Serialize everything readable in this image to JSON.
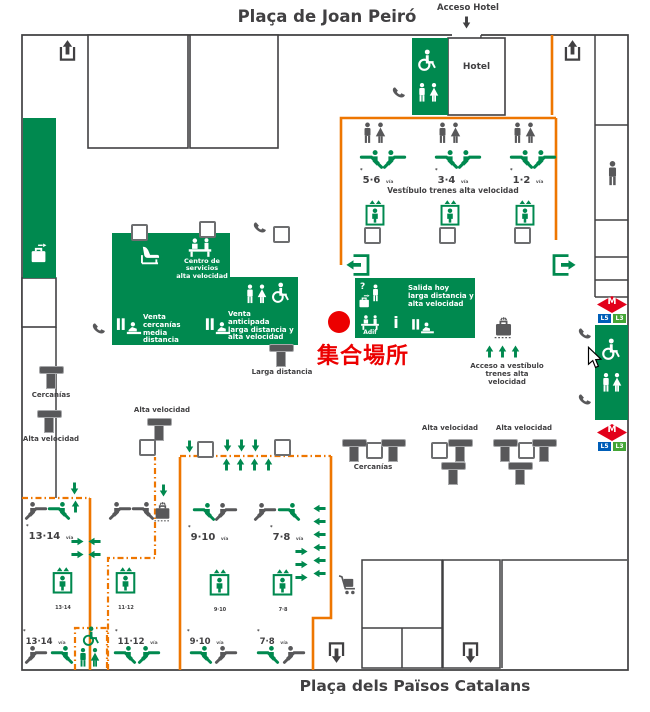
{
  "colors": {
    "green": "#00894f",
    "orange": "#ee7601",
    "dark_gray": "#414042",
    "icon_gray": "#58585a",
    "red": "#ec0000",
    "metro_red": "#e2001a",
    "line5_blue": "#005eb8",
    "line3_green": "#43a536"
  },
  "header": {
    "title": "Plaça de Joan Peiró",
    "acceso_hotel": "Acceso Hotel"
  },
  "footer": {
    "title": "Plaça dels Països Catalans"
  },
  "hotel": {
    "label": "Hotel"
  },
  "vestibulo": {
    "label": "Vestíbulo trenes alta velocidad",
    "platforms": [
      {
        "num": "5·6",
        "suffix": "vía"
      },
      {
        "num": "3·4",
        "suffix": "vía"
      },
      {
        "num": "1·2",
        "suffix": "vía"
      }
    ]
  },
  "services": {
    "centro_servicios": "Centro de servicios\nalta velocidad",
    "venta_cercanias": "Venta\ncercanías\nmedia distancia",
    "venta_anticipada": "Venta anticipada\nlarga distancia y\nalta velocidad",
    "salida_hoy": "Salida hoy\nlarga distancia y\nalta velocidad",
    "adif": "Adif",
    "info_letter": "i",
    "question_mark": "?"
  },
  "signs": {
    "larga_distancia": "Larga distancia",
    "cercanias_left": "Cercanías",
    "alta_velocidad_left": "Alta velocidad",
    "alta_velocidad_center": "Alta velocidad",
    "cercanias_mid": "Cercanías",
    "alta_velocidad_mid_1": "Alta velocidad",
    "alta_velocidad_mid_2": "Alta velocidad",
    "acceso_vestibulo": "Acceso a vestíbulo\ntrenes alta velocidad"
  },
  "meeting_point": {
    "label": "集合場所"
  },
  "platforms_lower": {
    "groups": [
      {
        "num": "13·14",
        "suffix": "vía",
        "lift": "13·14"
      },
      {
        "lift": "11·12"
      },
      {
        "num": "9·10",
        "suffix": "vía",
        "lift": "9·10"
      },
      {
        "num": "7·8",
        "suffix": "vía",
        "lift": "7·8"
      }
    ],
    "bottom_row": [
      {
        "num": "13·14",
        "suffix": "vía"
      },
      {
        "num": "11·12",
        "suffix": "vía"
      },
      {
        "num": "9·10",
        "suffix": "vía"
      },
      {
        "num": "7·8",
        "suffix": "vía"
      }
    ]
  },
  "metro": {
    "m": "M",
    "l5": "L5",
    "l3": "L3"
  },
  "misc": {
    "track_marker": "*"
  }
}
